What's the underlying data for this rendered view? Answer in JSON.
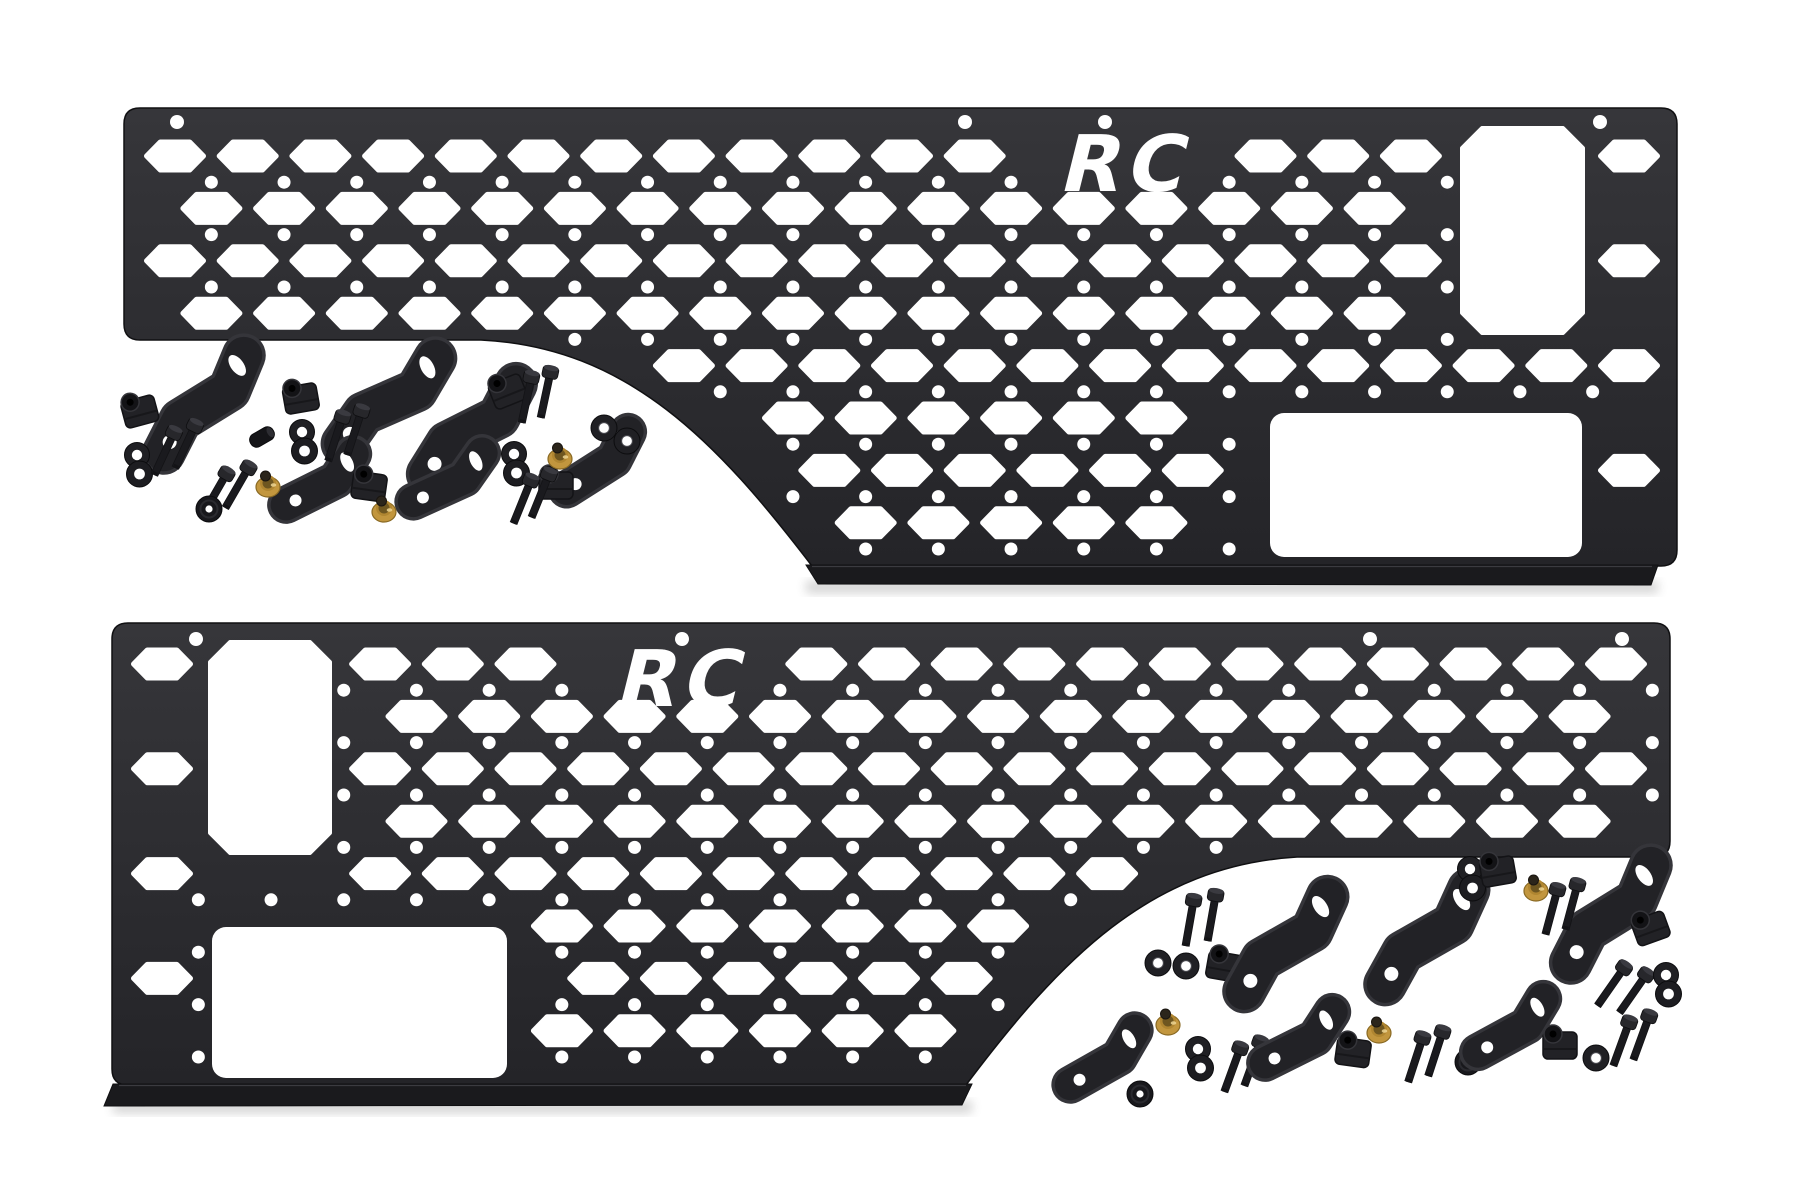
{
  "image": {
    "kind": "product-photo",
    "background": "#ffffff"
  },
  "brand": {
    "logo_text": "RC"
  },
  "colors": {
    "panel_base": "#2b2b2e",
    "panel_grad_top": "#36363a",
    "panel_grad_bottom": "#242428",
    "panel_edge": "#101012",
    "flange": "#1a1a1d",
    "flange_highlight": "#4a4a50",
    "cutout": "#ffffff",
    "hardware_base": "#222226",
    "hardware_dark": "#131316",
    "hardware_mid": "#35353a",
    "brass": "#c2963e",
    "brass_dark": "#8a6a24",
    "brass_deep": "#6e5620",
    "brass_knob": "#2b251b",
    "brass_highlight": "#eed694",
    "shadow": "#000000"
  },
  "panels": [
    {
      "id": "top",
      "frame": {
        "left": 124,
        "top": 108,
        "right": 1677,
        "shortBottom": 340,
        "tallBottom": 566,
        "notch": "left"
      },
      "curve": {
        "a": [
          481,
          340
        ],
        "c1": [
          628,
          347
        ],
        "c2": [
          718,
          443
        ],
        "b": [
          812,
          566
        ]
      },
      "flange": [
        [
          806,
          565
        ],
        [
          1658,
          565
        ],
        [
          1651,
          585
        ],
        [
          818,
          584
        ]
      ],
      "rects": [
        {
          "x": 1462,
          "y": 128,
          "w": 121,
          "h": 205,
          "style": "chamfer"
        },
        {
          "x": 1270,
          "y": 413,
          "w": 312,
          "h": 144,
          "style": "round"
        }
      ],
      "grid": {
        "row0": 156,
        "col0": 175,
        "rows": 8,
        "pitchX": 72.7,
        "pitchY": 52.4,
        "hexW": 57,
        "hexH": 28,
        "holeR": 6.5
      },
      "logo": {
        "cx": 1122,
        "baseline": 191,
        "box": [
          1050,
          132,
          145,
          62
        ]
      },
      "topHoles": {
        "y": 122,
        "xs": [
          177,
          965,
          1105,
          1600
        ]
      }
    },
    {
      "id": "bottom",
      "frame": {
        "left": 112,
        "top": 623,
        "right": 1670,
        "shortBottom": 857,
        "tallBottom": 1085,
        "notch": "right"
      },
      "curve": {
        "a": [
          1297,
          857
        ],
        "c1": [
          1150,
          866
        ],
        "c2": [
          1060,
          960
        ],
        "b": [
          966,
          1085
        ]
      },
      "flange": [
        [
          113,
          1084
        ],
        [
          972,
          1084
        ],
        [
          962,
          1105
        ],
        [
          104,
          1106
        ]
      ],
      "rects": [
        {
          "x": 210,
          "y": 642,
          "w": 120,
          "h": 211,
          "style": "chamfer"
        },
        {
          "x": 212,
          "y": 927,
          "w": 295,
          "h": 151,
          "style": "round"
        }
      ],
      "grid": {
        "row0": 664,
        "col0": 162,
        "rows": 8,
        "pitchX": 72.7,
        "pitchY": 52.4,
        "hexW": 57,
        "hexH": 28,
        "holeR": 6.5
      },
      "logo": {
        "cx": 678,
        "baseline": 706,
        "box": [
          605,
          646,
          145,
          64
        ]
      },
      "topHoles": {
        "y": 639,
        "xs": [
          196,
          682,
          1370,
          1622
        ]
      }
    }
  ],
  "hardware": [
    [
      "bracket-large",
      205,
      405,
      38
    ],
    [
      "bracket-large",
      390,
      402,
      46
    ],
    [
      "bracket-large",
      473,
      430,
      43
    ],
    [
      "bracket-small",
      322,
      482,
      48
    ],
    [
      "bracket-small",
      450,
      480,
      50
    ],
    [
      "bracket-small",
      600,
      463,
      42
    ],
    [
      "clip-nut",
      140,
      412,
      -15
    ],
    [
      "clip-nut",
      301,
      399,
      -10
    ],
    [
      "clip-nut",
      508,
      392,
      -22
    ],
    [
      "clip-nut",
      369,
      487,
      8
    ],
    [
      "clip-nut",
      556,
      486,
      0
    ],
    [
      "washer-pair",
      137,
      464,
      0
    ],
    [
      "washer-pair",
      302,
      441,
      0
    ],
    [
      "washer-pair",
      514,
      463,
      0
    ],
    [
      "washer",
      604,
      428,
      0
    ],
    [
      "washer",
      627,
      441,
      0
    ],
    [
      "bolt",
      165,
      452,
      25
    ],
    [
      "bolt",
      186,
      445,
      25
    ],
    [
      "bolt",
      336,
      437,
      18
    ],
    [
      "bolt",
      355,
      431,
      18
    ],
    [
      "bolt",
      527,
      398,
      12
    ],
    [
      "bolt",
      546,
      393,
      12
    ],
    [
      "bolt",
      216,
      492,
      30
    ],
    [
      "bolt",
      238,
      486,
      30
    ],
    [
      "bolt",
      523,
      500,
      22
    ],
    [
      "bolt",
      541,
      494,
      22
    ],
    [
      "well-nut",
      268,
      484,
      0
    ],
    [
      "well-nut",
      384,
      509,
      0
    ],
    [
      "well-nut",
      560,
      456,
      0
    ],
    [
      "grommet",
      209,
      509,
      0
    ],
    [
      "spacer",
      262,
      437,
      60
    ],
    [
      "bolt",
      1190,
      921,
      10
    ],
    [
      "bolt",
      1212,
      916,
      10
    ],
    [
      "washer",
      1158,
      963,
      0
    ],
    [
      "washer",
      1186,
      966,
      0
    ],
    [
      "clip-nut",
      1224,
      967,
      10
    ],
    [
      "bracket-large",
      1287,
      945,
      40
    ],
    [
      "bracket-large",
      1428,
      938,
      40
    ],
    [
      "bracket-large",
      1612,
      915,
      38
    ],
    [
      "washer-pair",
      1470,
      878,
      0
    ],
    [
      "clip-nut",
      1498,
      872,
      -10
    ],
    [
      "well-nut",
      1536,
      888,
      0
    ],
    [
      "bolt",
      1552,
      910,
      15
    ],
    [
      "bolt",
      1572,
      905,
      15
    ],
    [
      "clip-nut",
      1651,
      929,
      -20
    ],
    [
      "bolt",
      1612,
      985,
      35
    ],
    [
      "bolt",
      1634,
      992,
      35
    ],
    [
      "washer-pair",
      1666,
      984,
      0
    ],
    [
      "bracket-small",
      1105,
      1060,
      45
    ],
    [
      "grommet",
      1140,
      1094,
      0
    ],
    [
      "well-nut",
      1168,
      1022,
      0
    ],
    [
      "washer-pair",
      1198,
      1058,
      0
    ],
    [
      "bolt",
      1233,
      1068,
      20
    ],
    [
      "bolt",
      1253,
      1062,
      20
    ],
    [
      "bracket-small",
      1301,
      1040,
      48
    ],
    [
      "clip-nut",
      1353,
      1053,
      8
    ],
    [
      "well-nut",
      1379,
      1030,
      0
    ],
    [
      "bolt",
      1416,
      1058,
      18
    ],
    [
      "bolt",
      1436,
      1052,
      18
    ],
    [
      "grommet",
      1468,
      1062,
      0
    ],
    [
      "bracket-small",
      1513,
      1028,
      46
    ],
    [
      "clip-nut",
      1560,
      1046,
      0
    ],
    [
      "washer",
      1596,
      1058,
      0
    ],
    [
      "bolt",
      1622,
      1042,
      20
    ],
    [
      "bolt",
      1642,
      1036,
      20
    ]
  ]
}
